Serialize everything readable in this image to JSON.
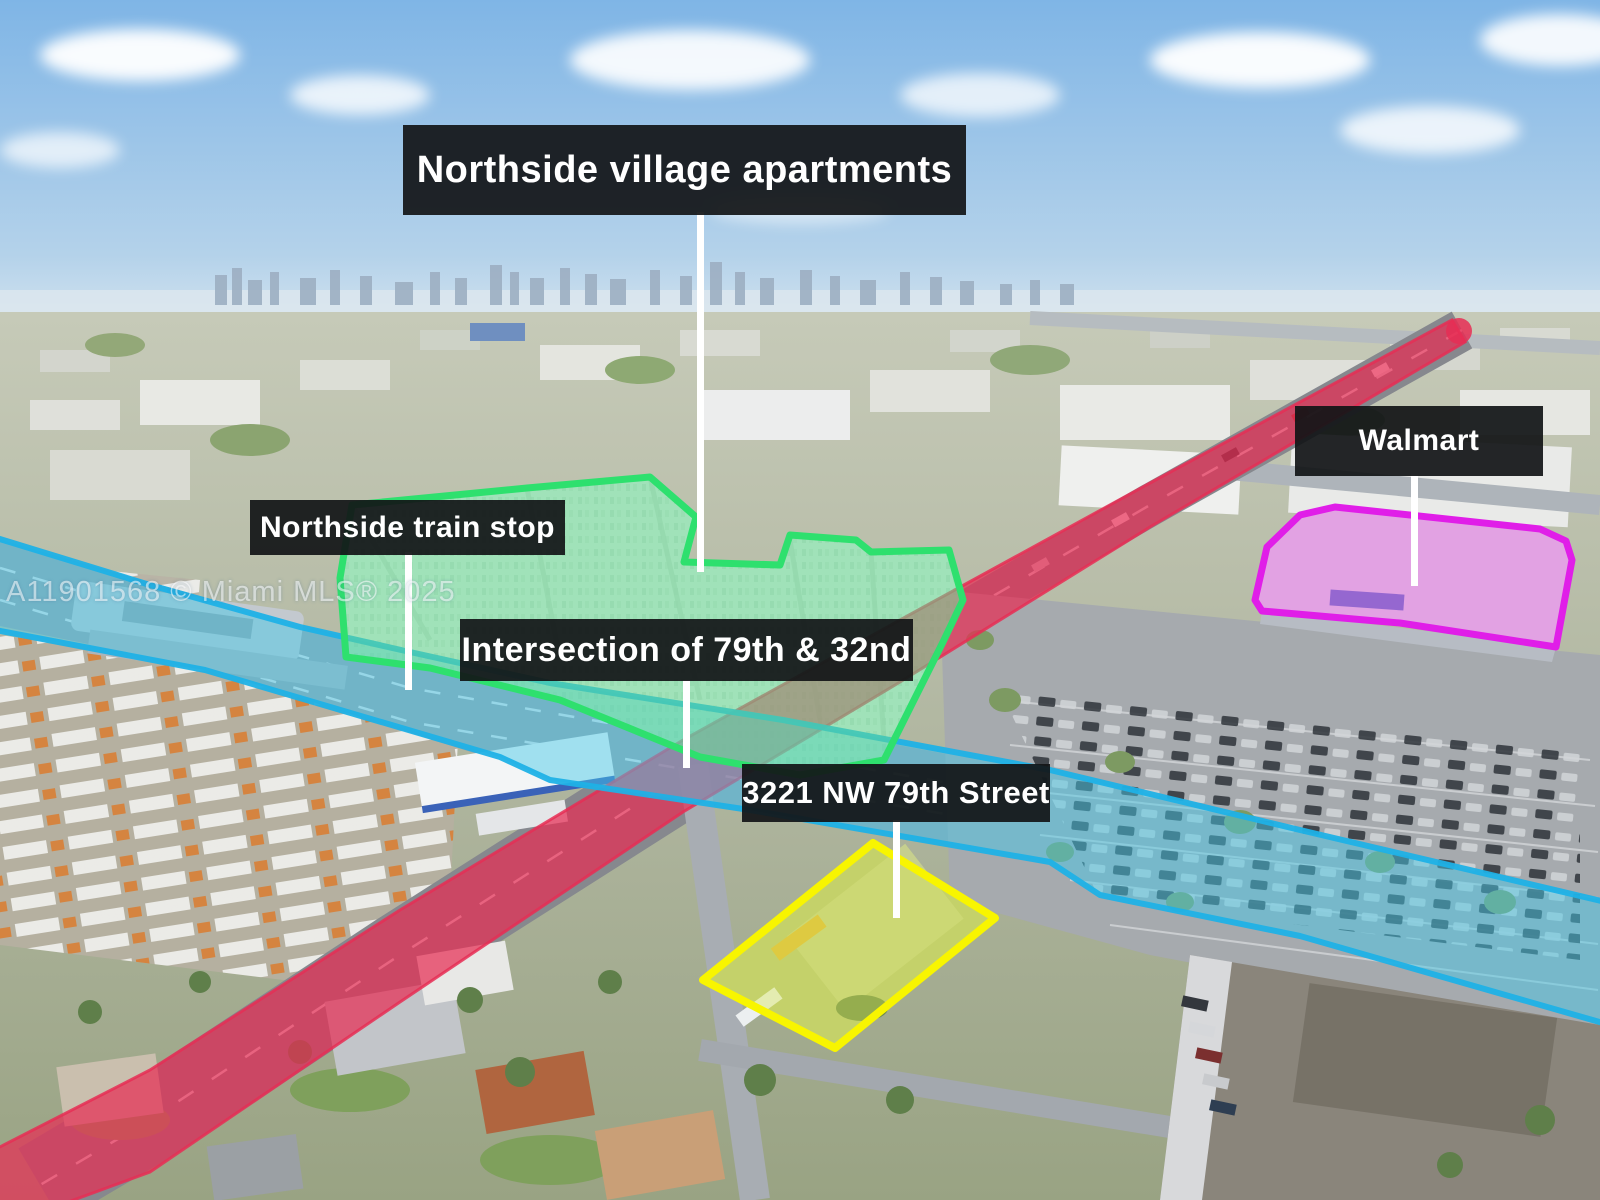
{
  "image": {
    "width": 1600,
    "height": 1200,
    "description": "Aerial drone photo of Miami with real-estate location annotations"
  },
  "watermark": {
    "text": "A11901568 © Miami MLS® 2025"
  },
  "labels": {
    "apartments": {
      "text": "Northside village apartments"
    },
    "walmart": {
      "text": "Walmart"
    },
    "train_stop": {
      "text": "Northside train stop"
    },
    "intersection": {
      "text": "Intersection of 79th & 32nd"
    },
    "address": {
      "text": "3221 NW 79th Street"
    }
  },
  "colors": {
    "label_bg": "#121517ec",
    "label_text": "#ffffff",
    "leader_line": "#ffffff",
    "watermark": "#ffffff8f",
    "street_overlay": "#e62e55",
    "expressway_fill": "#46c8e8",
    "expressway_stroke": "#1fb1e6",
    "apartments_fill": "#63d98f",
    "apartments_stroke": "#2ee06e",
    "walmart_fill": "#e06ce4",
    "walmart_stroke": "#e01ee8",
    "property_fill": "#d8e84a",
    "property_stroke": "#f8f500"
  }
}
